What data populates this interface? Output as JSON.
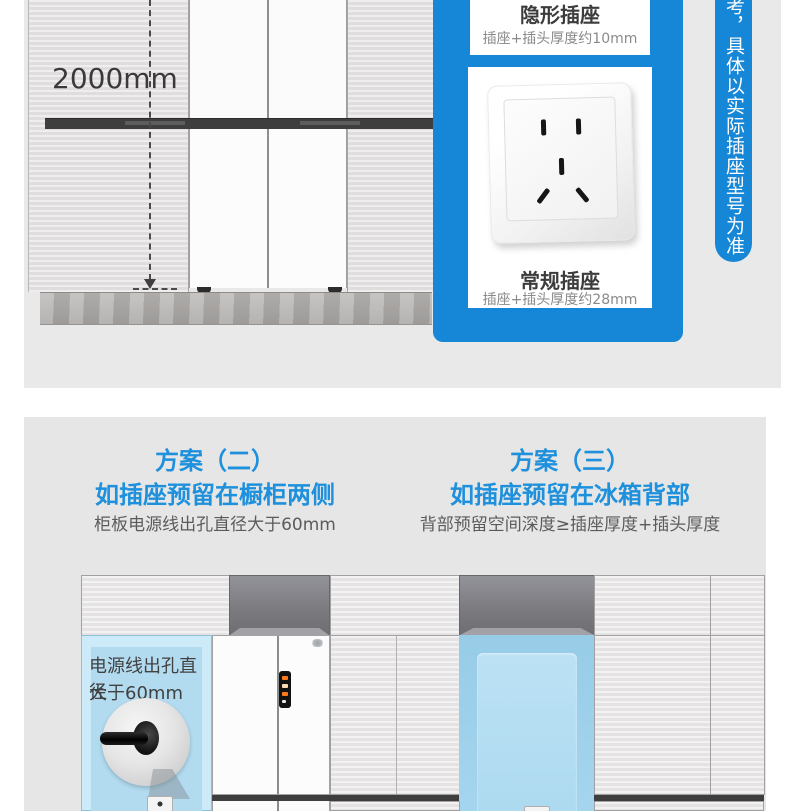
{
  "colors": {
    "brand_blue": "#1686d7",
    "heading_blue": "#1e90dc",
    "highlight_blue": "#b2dbf0",
    "section_bg_top": "#e9e9e9",
    "section_bg_bottom": "#e6e6e6",
    "dark_band": "#3e3e3e"
  },
  "top": {
    "measurement": "2000mm",
    "panel": {
      "hidden": {
        "title": "隐形插座",
        "subtitle": "插座+插头厚度约10mm"
      },
      "regular": {
        "title": "常规插座",
        "subtitle": "插座+插头厚度约28mm"
      }
    },
    "side_note": "考，具体以实际插座型号为准"
  },
  "plans": {
    "plan2": {
      "title": "方案（二）",
      "subtitle": "如插座预留在橱柜两侧",
      "note": "柜板电源线出孔直径大于60mm",
      "callout": {
        "line1": "电源线出孔直径",
        "line2": "大于60mm"
      }
    },
    "plan3": {
      "title": "方案（三）",
      "subtitle": "如插座预留在冰箱背部",
      "note": "背部预留空间深度≥插座厚度+插头厚度"
    }
  }
}
